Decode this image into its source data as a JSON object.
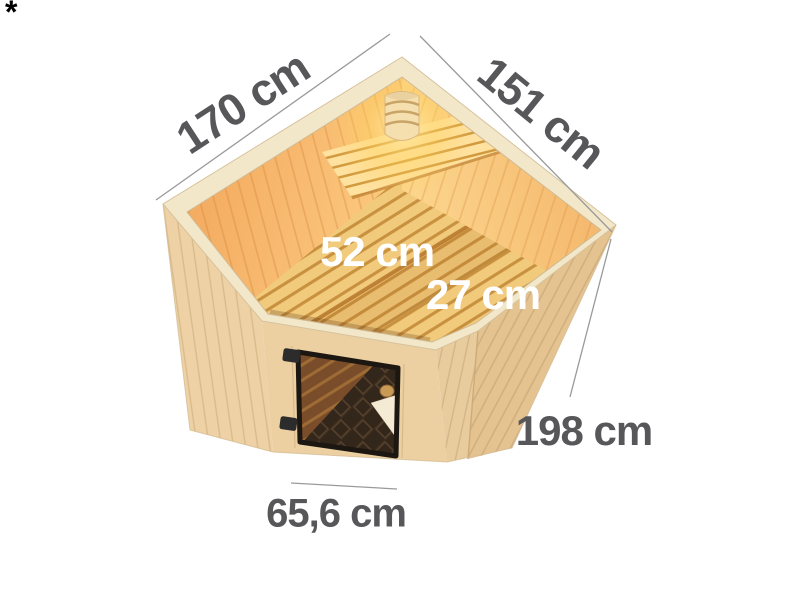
{
  "footnote": {
    "marker": "*"
  },
  "diagram": {
    "type": "corner-sauna-dimension-diagram",
    "dimensions": [
      {
        "id": "left-wall-width",
        "text": "170 cm",
        "value": 170,
        "unit": "cm"
      },
      {
        "id": "right-wall-width",
        "text": "151 cm",
        "value": 151,
        "unit": "cm"
      },
      {
        "id": "bench-depth",
        "text": "52 cm",
        "value": 52,
        "unit": "cm"
      },
      {
        "id": "bench-step-depth",
        "text": "27 cm",
        "value": 27,
        "unit": "cm"
      },
      {
        "id": "wall-height",
        "text": "198 cm",
        "value": 198,
        "unit": "cm"
      },
      {
        "id": "door-width",
        "text": "65,6 cm",
        "value": 65.6,
        "unit": "cm"
      }
    ],
    "elements": [
      "corner-sauna",
      "bronze-glass-door",
      "door-handle",
      "door-hinges",
      "interior-benches",
      "backrest",
      "corner-light"
    ],
    "colors": {
      "background": "#ffffff",
      "label_dark": "#57575a",
      "label_light": "#ffffff",
      "dimension_line": "#9a9a9a",
      "wood_exterior": "#ecd0a3",
      "wood_rim": "#f3e7ca",
      "wood_interior_warm": "#f2a75d",
      "wood_bench": "#f1ca7c",
      "door_glass": "#33261a",
      "light_glow": "#ffd35e"
    }
  }
}
